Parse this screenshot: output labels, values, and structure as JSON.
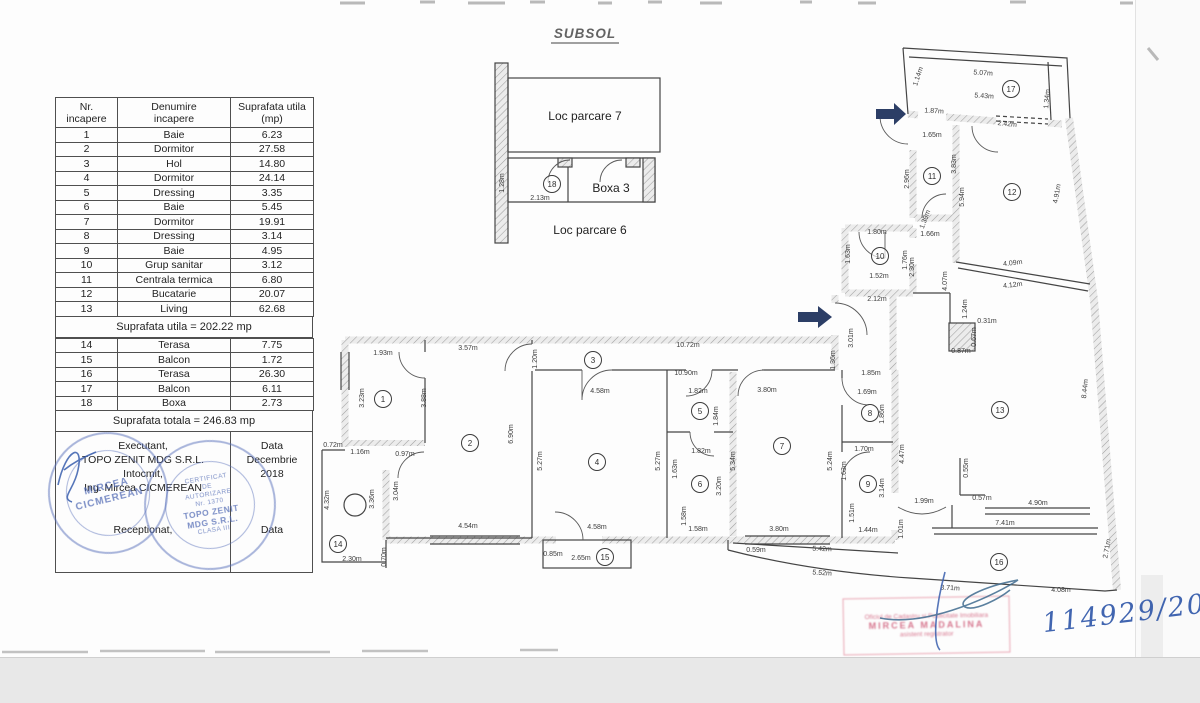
{
  "title": "SUBSOL",
  "table": {
    "headers": [
      "Nr.\nincapere",
      "Denumire\nincapere",
      "Suprafata utila\n(mp)"
    ],
    "rows1": [
      [
        "1",
        "Baie",
        "6.23"
      ],
      [
        "2",
        "Dormitor",
        "27.58"
      ],
      [
        "3",
        "Hol",
        "14.80"
      ],
      [
        "4",
        "Dormitor",
        "24.14"
      ],
      [
        "5",
        "Dressing",
        "3.35"
      ],
      [
        "6",
        "Baie",
        "5.45"
      ],
      [
        "7",
        "Dormitor",
        "19.91"
      ],
      [
        "8",
        "Dressing",
        "3.14"
      ],
      [
        "9",
        "Baie",
        "4.95"
      ],
      [
        "10",
        "Grup sanitar",
        "3.12"
      ],
      [
        "11",
        "Centrala termica",
        "6.80"
      ],
      [
        "12",
        "Bucatarie",
        "20.07"
      ],
      [
        "13",
        "Living",
        "62.68"
      ]
    ],
    "subtotal": "Suprafata utila = 202.22 mp",
    "rows2": [
      [
        "14",
        "Terasa",
        "7.75"
      ],
      [
        "15",
        "Balcon",
        "1.72"
      ],
      [
        "16",
        "Terasa",
        "26.30"
      ],
      [
        "17",
        "Balcon",
        "6.11"
      ],
      [
        "18",
        "Boxa",
        "2.73"
      ]
    ],
    "total": "Suprafata totala = 246.83 mp",
    "sign": {
      "executant": "Executant,",
      "company": "TOPO ZENIT MDG S.R.L.",
      "intocmit": "Intocmit,",
      "engineer": "Ing. Mircea CICMEREAN",
      "receptionat": "Receptionat,",
      "data_label_top": "Data",
      "data_value": "Decembrie\n2018",
      "data_label_bottom": "Data"
    }
  },
  "plan": {
    "labels": [
      {
        "name": "label-loc-parcare-7",
        "t": "Loc parcare 7",
        "x": 585,
        "y": 120
      },
      {
        "name": "label-boxa-3",
        "t": "Boxa 3",
        "x": 611,
        "y": 192
      },
      {
        "name": "label-loc-parcare-6",
        "t": "Loc parcare 6",
        "x": 590,
        "y": 234
      }
    ],
    "rooms": [
      {
        "n": "1",
        "x": 383,
        "y": 399
      },
      {
        "n": "2",
        "x": 470,
        "y": 443
      },
      {
        "n": "3",
        "x": 593,
        "y": 360
      },
      {
        "n": "4",
        "x": 597,
        "y": 462
      },
      {
        "n": "5",
        "x": 700,
        "y": 411
      },
      {
        "n": "6",
        "x": 700,
        "y": 484
      },
      {
        "n": "7",
        "x": 782,
        "y": 446
      },
      {
        "n": "8",
        "x": 870,
        "y": 413
      },
      {
        "n": "9",
        "x": 868,
        "y": 484
      },
      {
        "n": "10",
        "x": 880,
        "y": 256
      },
      {
        "n": "11",
        "x": 932,
        "y": 176
      },
      {
        "n": "12",
        "x": 1012,
        "y": 192
      },
      {
        "n": "13",
        "x": 1000,
        "y": 410
      },
      {
        "n": "14",
        "x": 338,
        "y": 544
      },
      {
        "n": "15",
        "x": 605,
        "y": 557
      },
      {
        "n": "16",
        "x": 999,
        "y": 562
      },
      {
        "n": "17",
        "x": 1011,
        "y": 89
      },
      {
        "n": "18",
        "x": 552,
        "y": 184
      }
    ],
    "dims": [
      {
        "t": "1.28m",
        "x": 504,
        "y": 183,
        "r": -90
      },
      {
        "t": "2.13m",
        "x": 540,
        "y": 200,
        "r": 0
      },
      {
        "t": "1.93m",
        "x": 383,
        "y": 355,
        "r": 0
      },
      {
        "t": "3.57m",
        "x": 468,
        "y": 350,
        "r": 0
      },
      {
        "t": "10.72m",
        "x": 688,
        "y": 347,
        "r": 0
      },
      {
        "t": "1.20m",
        "x": 537,
        "y": 359,
        "r": -90
      },
      {
        "t": "3.23m",
        "x": 364,
        "y": 398,
        "r": -90
      },
      {
        "t": "3.88m",
        "x": 426,
        "y": 398,
        "r": -90
      },
      {
        "t": "6.90m",
        "x": 513,
        "y": 434,
        "r": -90
      },
      {
        "t": "0.72m",
        "x": 333,
        "y": 447,
        "r": 0
      },
      {
        "t": "1.16m",
        "x": 360,
        "y": 454,
        "r": 0
      },
      {
        "t": "0.97m",
        "x": 405,
        "y": 456,
        "r": 0
      },
      {
        "t": "4.32m",
        "x": 329,
        "y": 500,
        "r": -90
      },
      {
        "t": "3.36m",
        "x": 374,
        "y": 499,
        "r": -90
      },
      {
        "t": "3.04m",
        "x": 398,
        "y": 491,
        "r": -90
      },
      {
        "t": "4.54m",
        "x": 468,
        "y": 528,
        "r": 0
      },
      {
        "t": "2.30m",
        "x": 352,
        "y": 561,
        "r": 0
      },
      {
        "t": "0.70m",
        "x": 386,
        "y": 557,
        "r": -90
      },
      {
        "t": "10.90m",
        "x": 686,
        "y": 375,
        "r": 0
      },
      {
        "t": "4.58m",
        "x": 600,
        "y": 393,
        "r": 0
      },
      {
        "t": "1.82m",
        "x": 698,
        "y": 393,
        "r": 0
      },
      {
        "t": "1.84m",
        "x": 718,
        "y": 416,
        "r": -90
      },
      {
        "t": "5.27m",
        "x": 542,
        "y": 461,
        "r": -90
      },
      {
        "t": "5.27m",
        "x": 660,
        "y": 461,
        "r": -90
      },
      {
        "t": "1.82m",
        "x": 701,
        "y": 453,
        "r": 0
      },
      {
        "t": "1.63m",
        "x": 677,
        "y": 469,
        "r": -90
      },
      {
        "t": "3.20m",
        "x": 721,
        "y": 486,
        "r": -90
      },
      {
        "t": "1.58m",
        "x": 686,
        "y": 516,
        "r": -90
      },
      {
        "t": "1.58m",
        "x": 698,
        "y": 531,
        "r": 0
      },
      {
        "t": "4.58m",
        "x": 597,
        "y": 529,
        "r": 0
      },
      {
        "t": "0.85m",
        "x": 553,
        "y": 556,
        "r": 0
      },
      {
        "t": "2.65m",
        "x": 581,
        "y": 560,
        "r": 0
      },
      {
        "t": "3.80m",
        "x": 767,
        "y": 392,
        "r": 0
      },
      {
        "t": "5.34m",
        "x": 735,
        "y": 461,
        "r": -90
      },
      {
        "t": "5.24m",
        "x": 832,
        "y": 461,
        "r": -90
      },
      {
        "t": "1.36m",
        "x": 835,
        "y": 360,
        "r": -90
      },
      {
        "t": "1.85m",
        "x": 871,
        "y": 375,
        "r": 0
      },
      {
        "t": "1.69m",
        "x": 867,
        "y": 394,
        "r": 0
      },
      {
        "t": "1.86m",
        "x": 884,
        "y": 414,
        "r": -90
      },
      {
        "t": "1.70m",
        "x": 864,
        "y": 451,
        "r": 0
      },
      {
        "t": "1.63m",
        "x": 846,
        "y": 471,
        "r": -90
      },
      {
        "t": "3.14m",
        "x": 884,
        "y": 488,
        "r": -90
      },
      {
        "t": "1.51m",
        "x": 854,
        "y": 513,
        "r": -90
      },
      {
        "t": "1.44m",
        "x": 868,
        "y": 532,
        "r": 0
      },
      {
        "t": "4.47m",
        "x": 904,
        "y": 454,
        "r": -90
      },
      {
        "t": "1.99m",
        "x": 924,
        "y": 503,
        "r": 0
      },
      {
        "t": "1.01m",
        "x": 903,
        "y": 529,
        "r": -90
      },
      {
        "t": "3.80m",
        "x": 779,
        "y": 531,
        "r": 0
      },
      {
        "t": "5.42m",
        "x": 822,
        "y": 551,
        "r": 2
      },
      {
        "t": "0.59m",
        "x": 756,
        "y": 552,
        "r": 0
      },
      {
        "t": "3.01m",
        "x": 853,
        "y": 338,
        "r": -90
      },
      {
        "t": "2.12m",
        "x": 877,
        "y": 301,
        "r": 0
      },
      {
        "t": "1.14m",
        "x": 920,
        "y": 77,
        "r": -72
      },
      {
        "t": "5.07m",
        "x": 983,
        "y": 75,
        "r": 4
      },
      {
        "t": "5.43m",
        "x": 984,
        "y": 98,
        "r": 4
      },
      {
        "t": "1.34m",
        "x": 1049,
        "y": 99,
        "r": -85
      },
      {
        "t": "1.87m",
        "x": 934,
        "y": 113,
        "r": 3
      },
      {
        "t": "2.42m",
        "x": 1007,
        "y": 126,
        "r": 6
      },
      {
        "t": "1.65m",
        "x": 932,
        "y": 137,
        "r": 0
      },
      {
        "t": "2.96m",
        "x": 909,
        "y": 179,
        "r": -90
      },
      {
        "t": "3.83m",
        "x": 956,
        "y": 164,
        "r": -90
      },
      {
        "t": "5.94m",
        "x": 964,
        "y": 197,
        "r": -90
      },
      {
        "t": "4.91m",
        "x": 1059,
        "y": 194,
        "r": -80
      },
      {
        "t": "1.39m",
        "x": 927,
        "y": 220,
        "r": -70
      },
      {
        "t": "1.66m",
        "x": 930,
        "y": 236,
        "r": 0
      },
      {
        "t": "1.80m",
        "x": 877,
        "y": 234,
        "r": 0
      },
      {
        "t": "1.63m",
        "x": 850,
        "y": 254,
        "r": -90
      },
      {
        "t": "1.76m",
        "x": 907,
        "y": 260,
        "r": -90
      },
      {
        "t": "2.30m",
        "x": 914,
        "y": 267,
        "r": -90
      },
      {
        "t": "1.52m",
        "x": 879,
        "y": 278,
        "r": 0
      },
      {
        "t": "4.07m",
        "x": 947,
        "y": 281,
        "r": -90
      },
      {
        "t": "4.09m",
        "x": 1013,
        "y": 265,
        "r": -7
      },
      {
        "t": "4.12m",
        "x": 1013,
        "y": 287,
        "r": -7
      },
      {
        "t": "1.24m",
        "x": 967,
        "y": 309,
        "r": -90
      },
      {
        "t": "0.31m",
        "x": 987,
        "y": 323,
        "r": 0
      },
      {
        "t": "0.67m",
        "x": 976,
        "y": 337,
        "r": -90
      },
      {
        "t": "0.87m",
        "x": 961,
        "y": 353,
        "r": 0
      },
      {
        "t": "8.44m",
        "x": 1087,
        "y": 389,
        "r": -84
      },
      {
        "t": "0.55m",
        "x": 968,
        "y": 468,
        "r": -90
      },
      {
        "t": "0.57m",
        "x": 982,
        "y": 500,
        "r": 0
      },
      {
        "t": "4.90m",
        "x": 1038,
        "y": 505,
        "r": 0
      },
      {
        "t": "7.41m",
        "x": 1005,
        "y": 525,
        "r": 0
      },
      {
        "t": "2.71m",
        "x": 1109,
        "y": 549,
        "r": -80
      },
      {
        "t": "5.52m",
        "x": 822,
        "y": 575,
        "r": 4
      },
      {
        "t": "3.71m",
        "x": 950,
        "y": 590,
        "r": 3
      },
      {
        "t": "4.08m",
        "x": 1061,
        "y": 592,
        "r": 0
      }
    ]
  },
  "stamps": {
    "round_left": {
      "lines": [
        "MIRCEA",
        "CICMEREAN"
      ]
    },
    "round_right": {
      "lines": [
        "CERTIFICAT",
        "DE",
        "AUTORIZARE",
        "Nr. 1370",
        "TOPO ZENIT",
        "MDG S.R.L.",
        "CLASA III"
      ]
    },
    "pink": {
      "lines": [
        "Oficiul de Cadastru si Publicitate Imobiliara",
        "MIRCEA MADALINA",
        "asistent registrator"
      ]
    },
    "handwritten": "114929/2018"
  }
}
